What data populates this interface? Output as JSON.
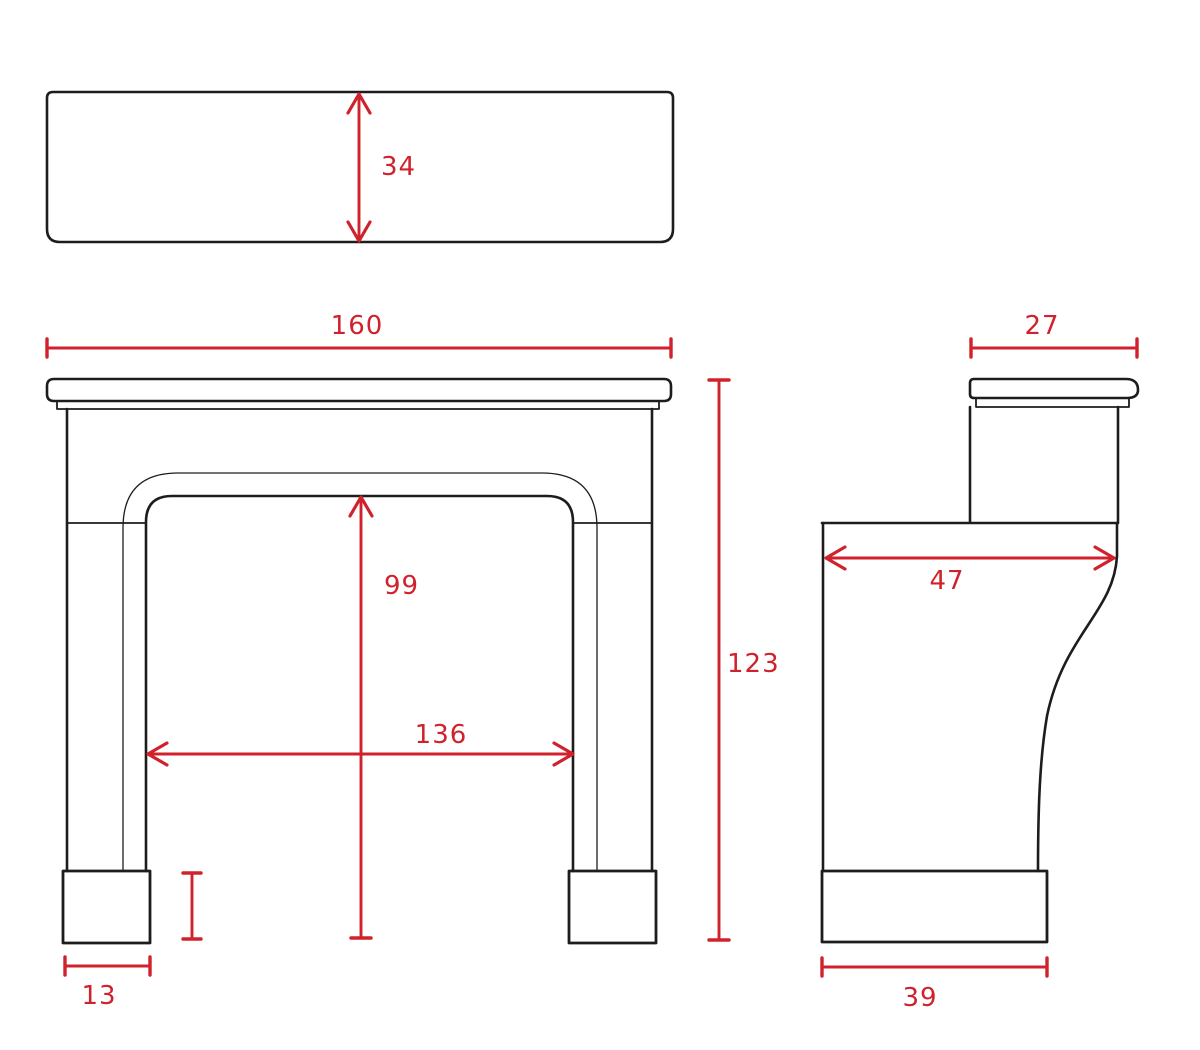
{
  "colors": {
    "outline": "#1d1d1b",
    "dimension": "#d0222c",
    "background": "#ffffff"
  },
  "dimensions": {
    "shelf_depth": "34",
    "overall_width": "160",
    "overall_height": "123",
    "opening_height": "99",
    "opening_width": "136",
    "foot_width": "13",
    "side_shelf_depth": "27",
    "side_body_depth": "47",
    "side_base_depth": "39"
  }
}
